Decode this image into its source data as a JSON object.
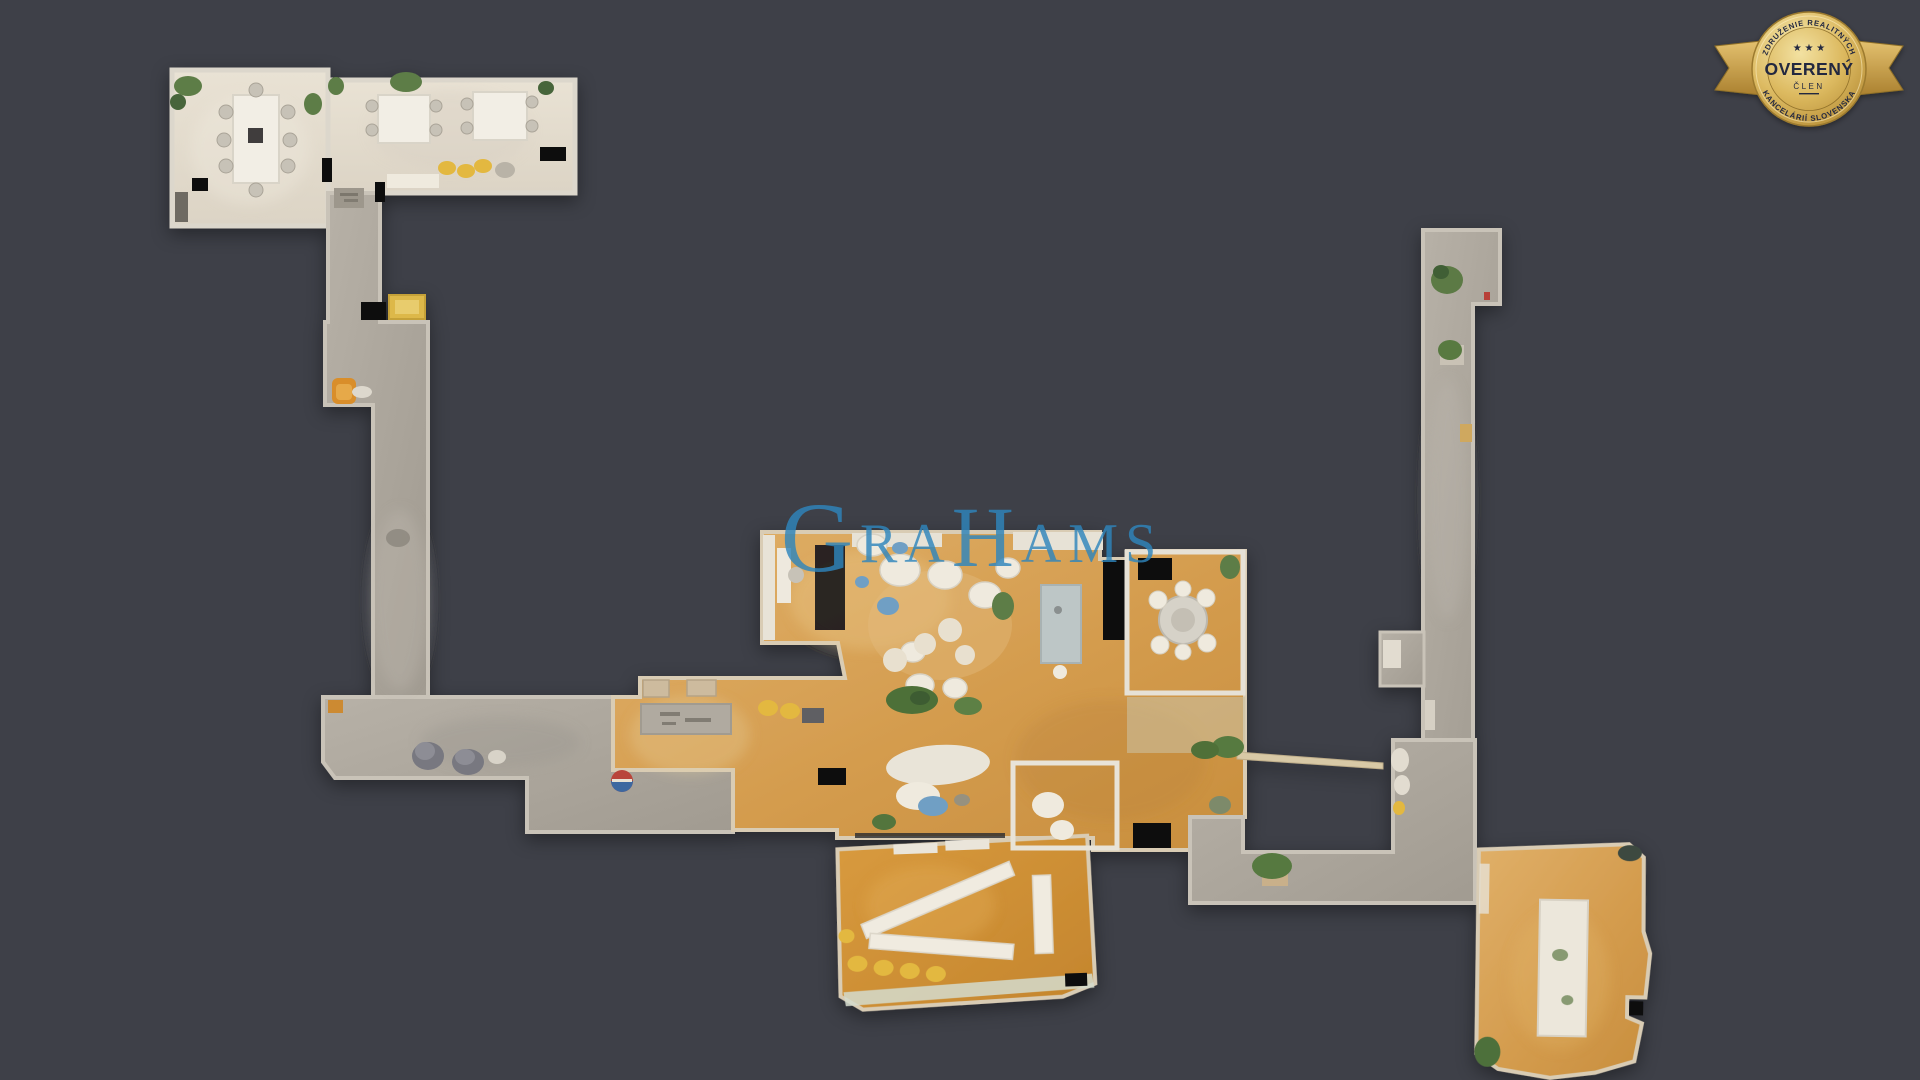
{
  "viewer": {
    "background_color": "#3e4048",
    "description": "Top-down 3D dollhouse floor plan scan of an office interior"
  },
  "watermark": {
    "text": "GRAHAMS",
    "g": "G",
    "ra": "RA",
    "h": "H",
    "ams": "AMS",
    "color": "#2f86bc"
  },
  "badge": {
    "association_top": "ZDRUŽENIE REALITNÝCH",
    "association_bottom": "KANCELÁRIÍ SLOVENSKA",
    "stars": "★ ★ ★",
    "title": "OVERENÝ",
    "subtitle": "ČLEN",
    "gold_light": "#f0dc9e",
    "gold_dark": "#b98c33",
    "text_color": "#232840"
  },
  "floorplan": {
    "colors": {
      "wood_floor": "#d9a255",
      "concrete_floor": "#aca69c",
      "cream_floor": "#e5ddcf",
      "wall": "#d8d2c7",
      "plant_green": "#5d7d46",
      "accent_yellow": "#e3b83f",
      "accent_orange": "#d98e2b",
      "accent_blue": "#6f9fc4",
      "void_black": "#0b0b0e"
    }
  }
}
